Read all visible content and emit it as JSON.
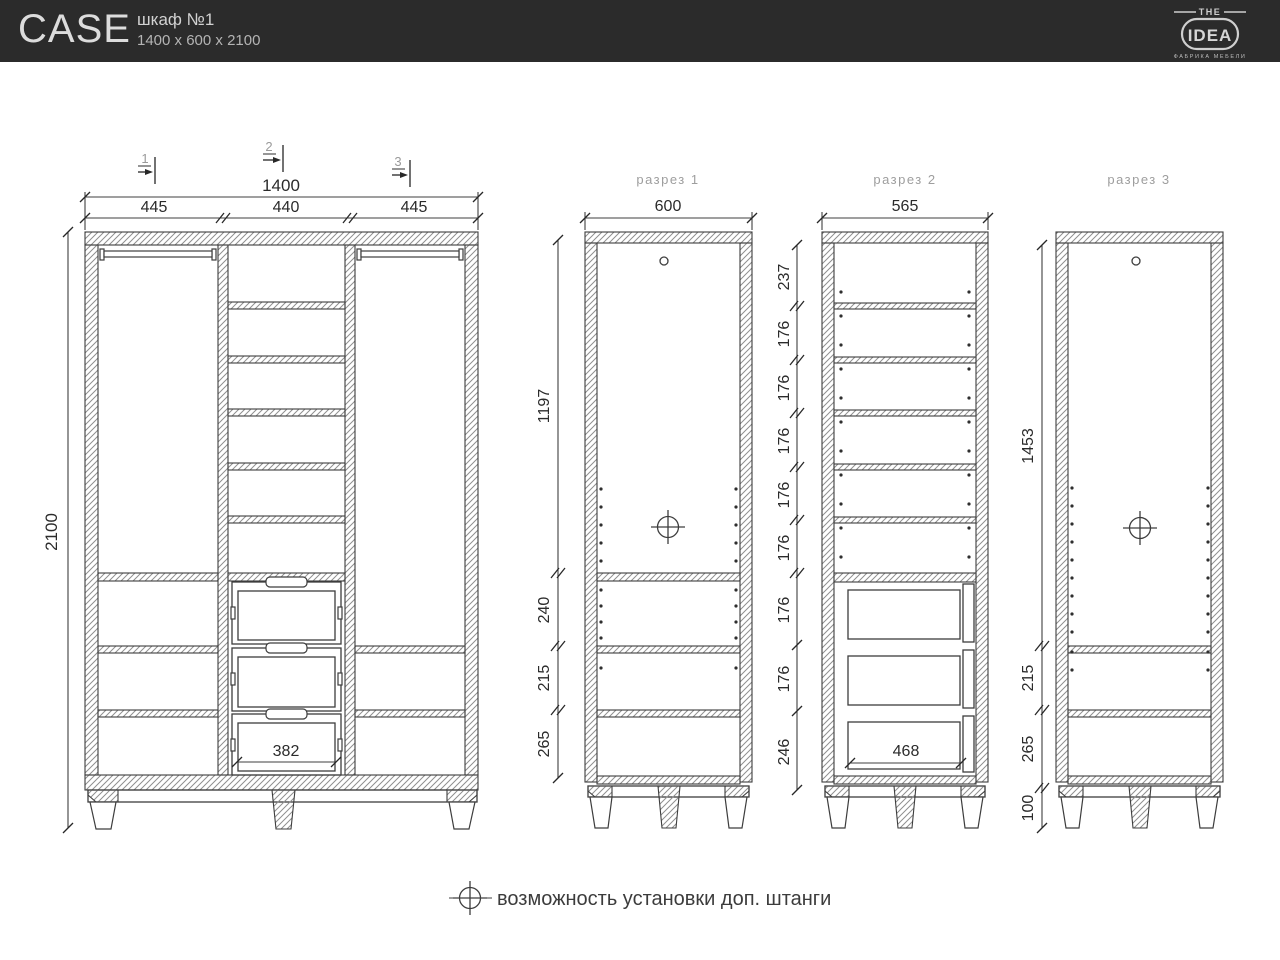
{
  "header": {
    "product": "CASE",
    "model": "шкаф №1",
    "size": "1400 x 600 x 2100",
    "logo": {
      "top": "THE",
      "name": "IDEA",
      "tagline": "ФАБРИКА МЕБЕЛИ"
    }
  },
  "front_view": {
    "section_markers": [
      "1",
      "2",
      "3"
    ],
    "dim_total_width": "1400",
    "dim_column_widths": [
      "445",
      "440",
      "445"
    ],
    "dim_total_height": "2100",
    "dim_drawer_inner_width": "382"
  },
  "sections": {
    "s1": {
      "title": "разрез 1",
      "dim_depth": "600",
      "dims_vertical": [
        "1197",
        "240",
        "215",
        "265"
      ]
    },
    "s2": {
      "title": "разрез 2",
      "dim_depth": "565",
      "dims_vertical": [
        "237",
        "176",
        "176",
        "176",
        "176",
        "176",
        "176",
        "176",
        "246"
      ],
      "dim_drawer_inner_depth": "468"
    },
    "s3": {
      "title": "разрез 3",
      "dims_vertical": [
        "1453",
        "215",
        "265",
        "100"
      ]
    }
  },
  "legend": {
    "note": "возможность установки доп. штанги"
  },
  "colors": {
    "header_bg": "#2b2b2b",
    "line": "#3d3d3d",
    "dim_text": "#2b2b2b",
    "muted_text": "#9e9e9e",
    "header_text": "#dcdcdc"
  }
}
